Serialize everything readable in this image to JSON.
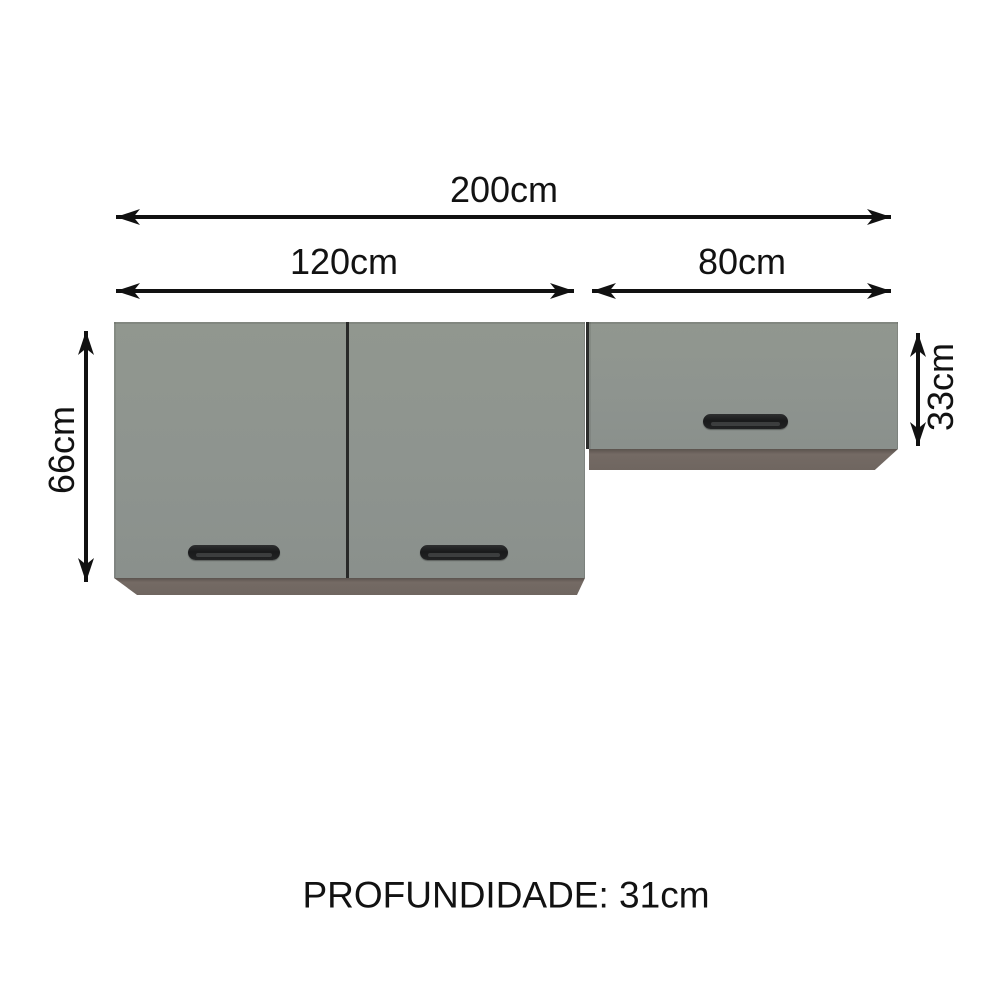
{
  "diagram": {
    "type": "product-dimensions",
    "unit": "cm",
    "labels": {
      "total_width": "200cm",
      "left_section_width": "120cm",
      "right_section_width": "80cm",
      "left_section_height": "66cm",
      "right_section_height": "33cm",
      "depth": "PROFUNDIDADE: 31cm"
    },
    "values": {
      "total_width_cm": 200,
      "left_section_width_cm": 120,
      "right_section_width_cm": 80,
      "left_section_height_cm": 66,
      "right_section_height_cm": 33,
      "depth_cm": 31
    },
    "cabinets": [
      {
        "name": "left-wall-cabinet",
        "width_cm": 120,
        "height_cm": 66,
        "doors": 2
      },
      {
        "name": "right-horizontal-wall-cabinet",
        "width_cm": 80,
        "height_cm": 33,
        "doors": 1
      }
    ],
    "colors": {
      "background": "#ffffff",
      "cabinet_front": "#8e948f",
      "cabinet_bottom_edge": "#6f6660",
      "door_separator": "#282928",
      "handle": "#1e1f20",
      "arrow": "#111111",
      "text": "#121212"
    }
  }
}
